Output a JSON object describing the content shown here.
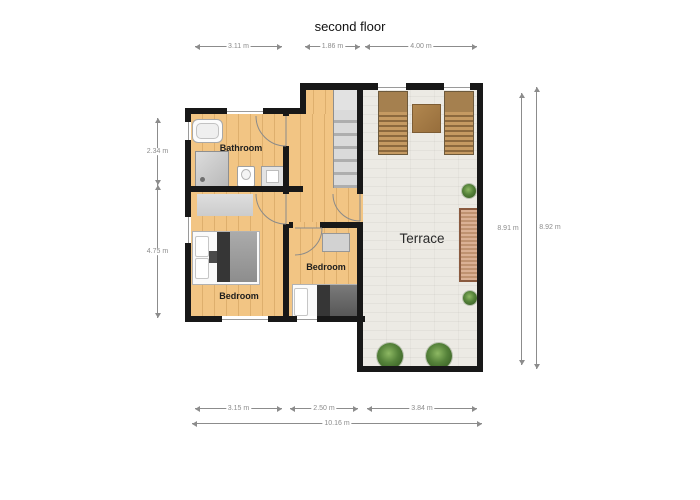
{
  "title": "second floor",
  "rooms": {
    "bathroom": {
      "label": "Bathroom"
    },
    "bedroom_left": {
      "label": "Bedroom"
    },
    "bedroom_right": {
      "label": "Bedroom"
    },
    "terrace": {
      "label": "Terrace"
    }
  },
  "dimensions": {
    "top": [
      "3.11 m",
      "1.86 m",
      "4.00 m"
    ],
    "left": [
      "2.34 m",
      "4.75 m"
    ],
    "right": [
      "8.91 m",
      "8.92 m"
    ],
    "bottom": [
      "3.15 m",
      "2.50 m",
      "3.84 m"
    ],
    "bottom_total": "10.16 m"
  },
  "furniture": [
    "bathtub",
    "shower",
    "toilet",
    "sink",
    "double-bed",
    "single-bed",
    "rug",
    "wardrobe",
    "stairs",
    "sun-lounger",
    "side-table",
    "slatted-bench",
    "plant"
  ],
  "colors": {
    "wall": "#181818",
    "wood_floor": "#f2c584",
    "terrace_floor": "#eceae4",
    "plant_green": "#55823a",
    "lounger_brown": "#a5804f"
  }
}
